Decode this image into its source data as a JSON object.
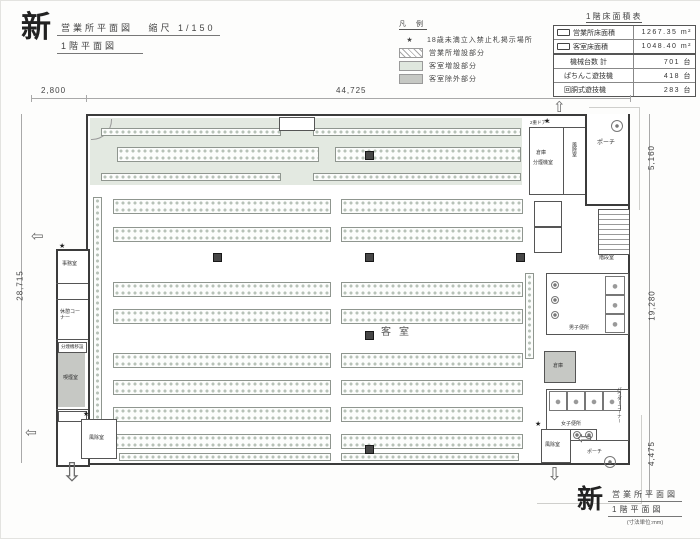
{
  "header": {
    "stamp": "新",
    "title": "営業所平面図",
    "scale": "縮尺 1/150",
    "subtitle": "1階平面図"
  },
  "legend": {
    "title": "凡 例",
    "star_item": {
      "symbol": "★",
      "label": "18歳未満立入禁止札掲示場所"
    },
    "items": [
      {
        "label": "営業所増設部分",
        "swatch": "hatch"
      },
      {
        "label": "客室増設部分",
        "swatch": "green"
      },
      {
        "label": "客室除外部分",
        "swatch": "gray"
      }
    ]
  },
  "area_table": {
    "title": "1階床面積表",
    "rows": [
      {
        "symbol": "rect",
        "label": "営業所床面積",
        "value": "1267.35",
        "unit": "m²"
      },
      {
        "symbol": "rect",
        "label": "客室床面積",
        "value": "1048.40",
        "unit": "m²"
      },
      {
        "symbol": "",
        "label": "機械台数 計",
        "value": "701",
        "unit": "台"
      },
      {
        "symbol": "",
        "label": "ぱちんこ遊技機",
        "value": "418",
        "unit": "台"
      },
      {
        "symbol": "",
        "label": "回胴式遊技機",
        "value": "283",
        "unit": "台"
      }
    ]
  },
  "dimensions": {
    "top": "44,725",
    "top_left": "2,800",
    "left": "28,715",
    "right_upper": "5,160",
    "right_mid": "19,280",
    "right_lower": "4,475"
  },
  "plan": {
    "hall": "客室",
    "stair_room": "階段室",
    "mens_toilet": "男子便所",
    "womens_toilet": "女子便所",
    "storage": "倉庫",
    "smoke_machine_room": "分煙機室",
    "powder_corner": "パウダーコーナー",
    "porch": "ポーチ",
    "windbreak_room": "風除室",
    "office": "事務室",
    "rest_corner": "休憩コーナー",
    "smoking_room": "喫煙室",
    "smoke_machine_note": "分煙機移設",
    "double_door_note": "2重ドアー",
    "star": "★"
  },
  "colors": {
    "expansion_green": "#e3e9e1",
    "excluded_gray": "#c6c8c4",
    "wall": "#3b3b3b"
  },
  "footer": {
    "stamp": "新",
    "title": "営業所平面図",
    "subtitle": "1階平面図",
    "units": "(寸法単位:mm)"
  }
}
